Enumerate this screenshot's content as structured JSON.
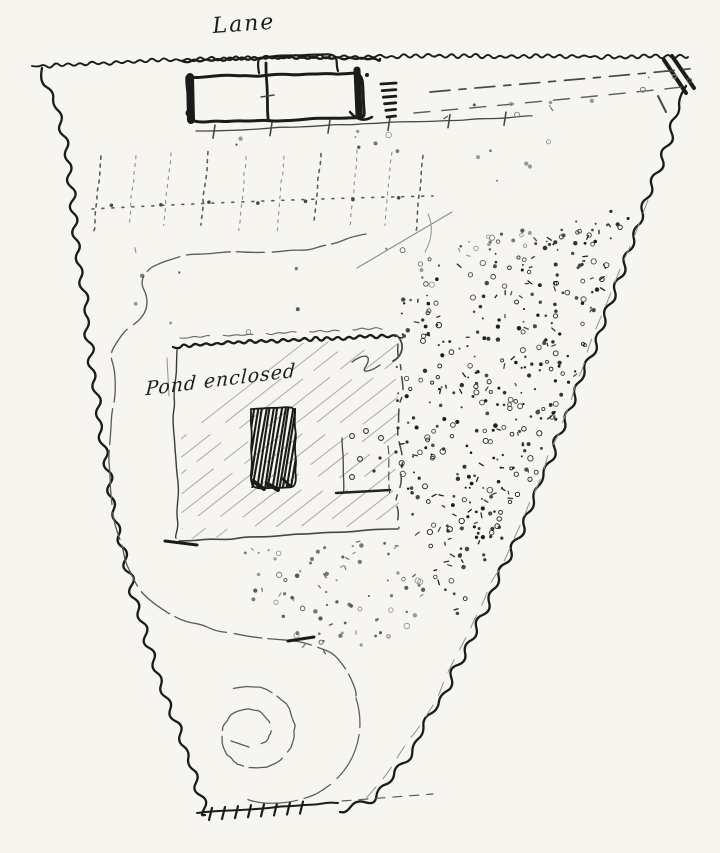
{
  "labels": {
    "lane": "Lane",
    "garden_note": "Pond enclosed"
  },
  "palette": {
    "paper": "#f7f5f0",
    "ink": "#1b1b1b",
    "ink_mid": "#474747",
    "ink_soft": "#5c5c5c",
    "ink_faint": "#8f8f8f",
    "hatch": "#9a9a9a"
  }
}
